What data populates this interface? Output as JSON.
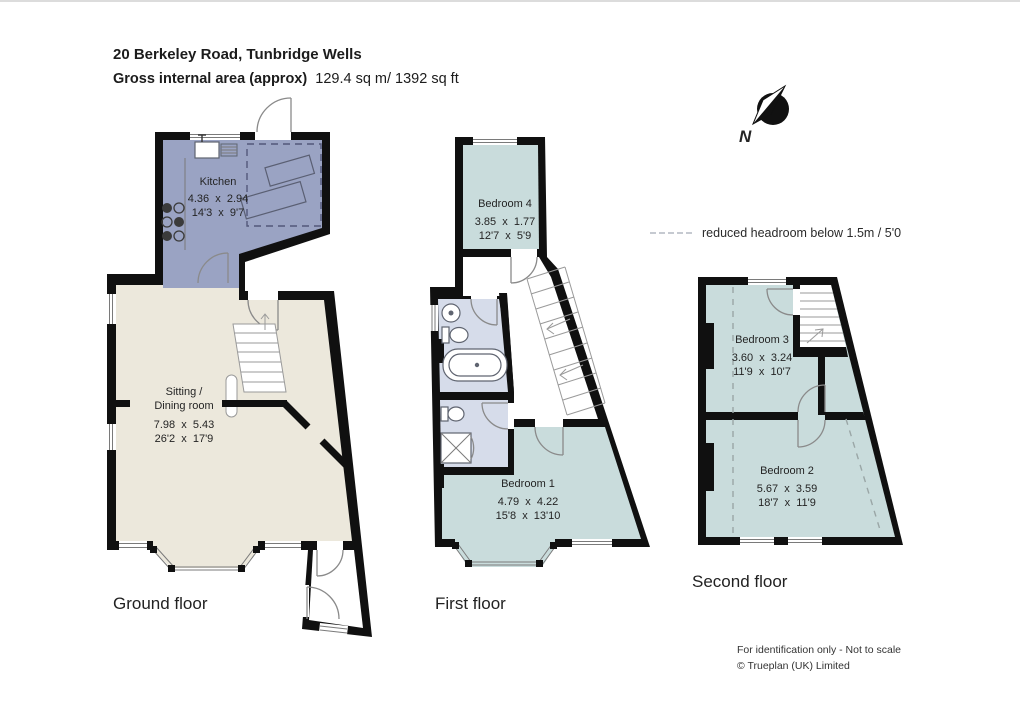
{
  "header": {
    "address": "20 Berkeley Road, Tunbridge Wells",
    "area_label": "Gross internal area (approx)",
    "area_value": "129.4 sq m/ 1392 sq ft"
  },
  "compass": {
    "north_label": "N"
  },
  "legend": {
    "reduced_headroom_label": "reduced headroom below 1.5m / 5'0"
  },
  "floors": {
    "ground": {
      "label": "Ground floor",
      "kitchen": {
        "name": "Kitchen",
        "metric": "4.36  x  2.94",
        "imperial": "14'3  x  9'7"
      },
      "sitting": {
        "name_line1": "Sitting /",
        "name_line2": "Dining room",
        "metric": "7.98  x  5.43",
        "imperial": "26'2  x  17'9"
      }
    },
    "first": {
      "label": "First floor",
      "bedroom4": {
        "name": "Bedroom 4",
        "metric": "3.85  x  1.77",
        "imperial": "12'7  x  5'9"
      },
      "bedroom1": {
        "name": "Bedroom 1",
        "metric": "4.79  x  4.22",
        "imperial": "15'8  x  13'10"
      }
    },
    "second": {
      "label": "Second floor",
      "bedroom3": {
        "name": "Bedroom 3",
        "metric": "3.60  x  3.24",
        "imperial": "11'9  x  10'7"
      },
      "bedroom2": {
        "name": "Bedroom 2",
        "metric": "5.67  x  3.59",
        "imperial": "18'7  x  11'9"
      }
    }
  },
  "footer": {
    "line1": "For identification only - Not to scale",
    "line2": "© Trueplan (UK) Limited"
  },
  "colors": {
    "wall": "#101010",
    "kitchen_fill": "#9aa3c3",
    "living_fill": "#ece8dc",
    "bedroom_fill": "#c9dcdc",
    "bathroom_fill": "#d6dcea",
    "hall_fill": "#ffffff"
  }
}
